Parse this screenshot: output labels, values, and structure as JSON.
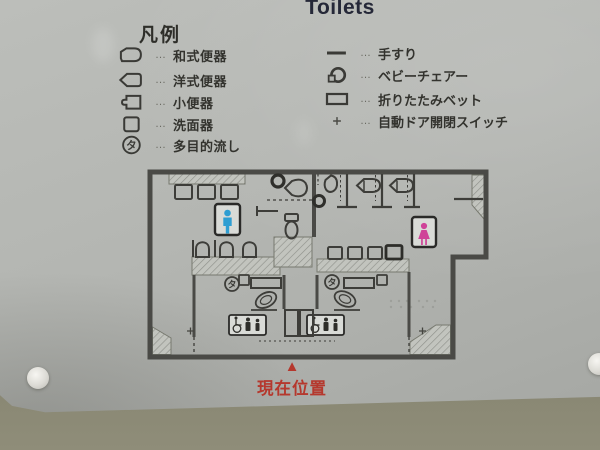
{
  "sign": {
    "title": "Toilets",
    "legend": {
      "heading": "凡例",
      "dots": "…",
      "left_items": [
        {
          "icon": "squat-toilet-icon",
          "label": "和式便器"
        },
        {
          "icon": "western-toilet-icon",
          "label": "洋式便器"
        },
        {
          "icon": "urinal-icon",
          "label": "小便器"
        },
        {
          "icon": "washbasin-icon",
          "label": "洗面器"
        },
        {
          "icon": "multipurpose-sink-icon",
          "label": "多目的流し",
          "icon_char": "タ"
        }
      ],
      "right_items": [
        {
          "icon": "handrail-icon",
          "label": "手すり"
        },
        {
          "icon": "baby-chair-icon",
          "label": "ベビーチェアー"
        },
        {
          "icon": "folding-bed-icon",
          "label": "折りたたみベット"
        },
        {
          "icon": "auto-door-switch-icon",
          "label": "自動ドア開閉スイッチ"
        }
      ]
    },
    "map": {
      "multipurpose_char": "タ",
      "mens_symbol_color": "#2e9ed2",
      "womens_symbol_color": "#cf4398",
      "current_location": {
        "marker": "▲",
        "label": "現在位置",
        "color": "#b5382d"
      }
    }
  }
}
